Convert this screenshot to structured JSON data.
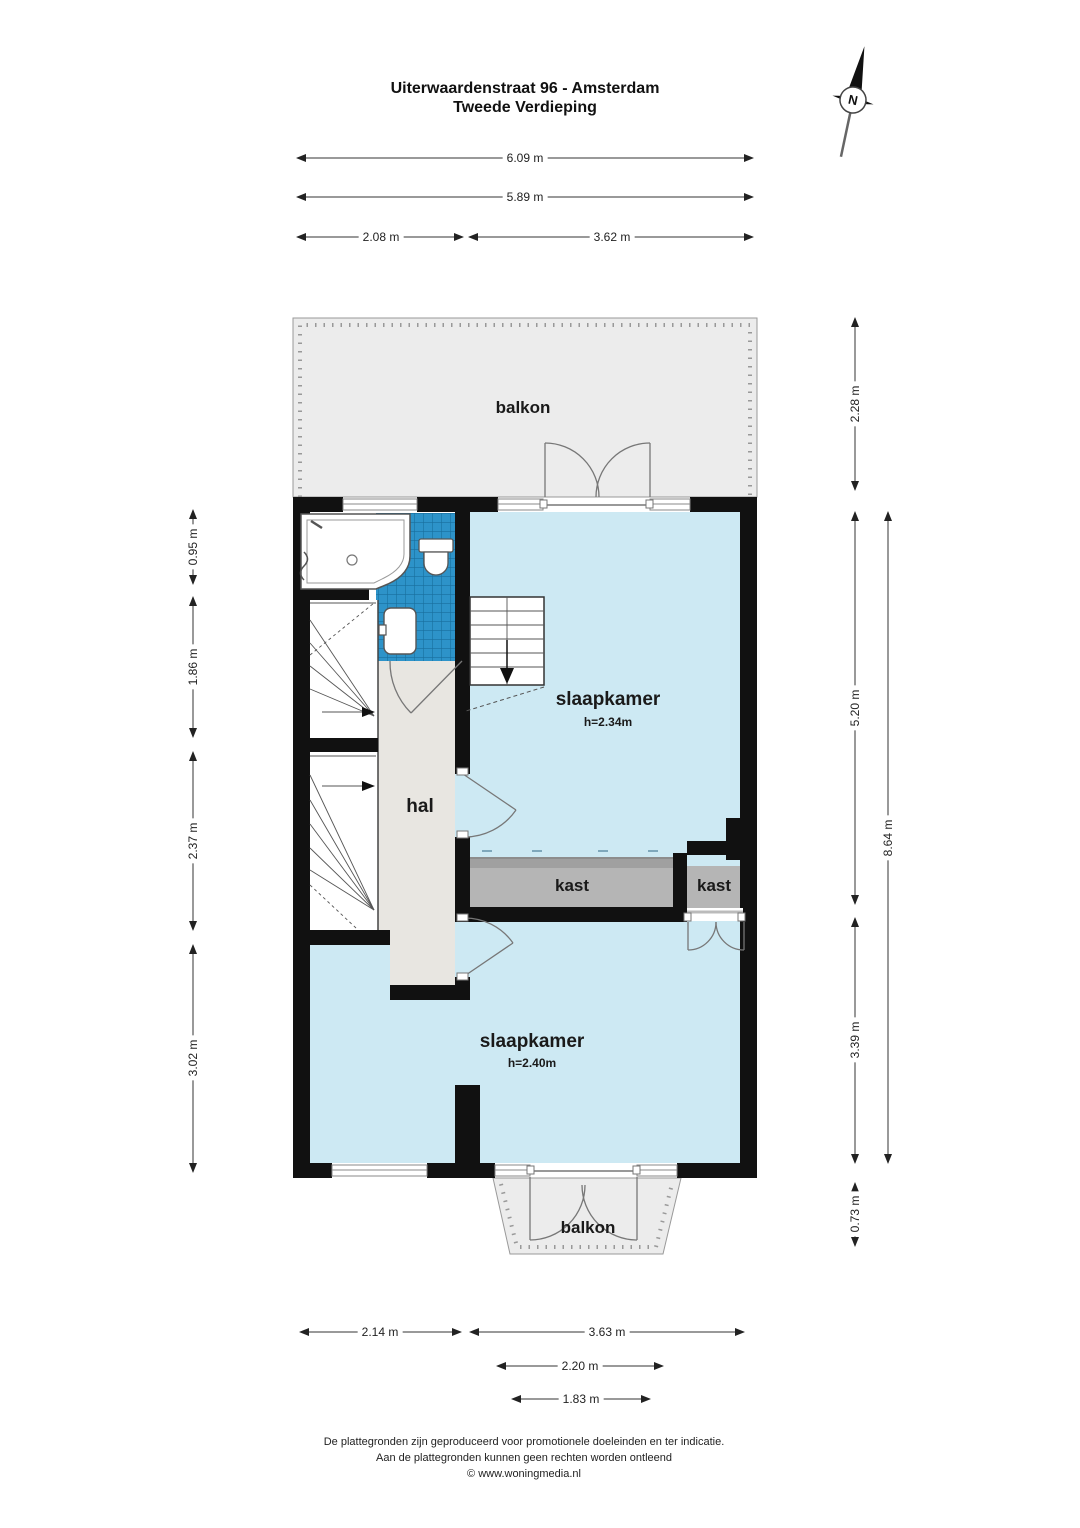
{
  "title": {
    "line1": "Uiterwaardenstraat 96 - Amsterdam",
    "line2": "Tweede Verdieping"
  },
  "compass": {
    "north_label": "N"
  },
  "rooms": {
    "balcony_top": {
      "label": "balkon"
    },
    "bedroom_top": {
      "label": "slaapkamer",
      "ceiling_height": "h=2.34m"
    },
    "hall": {
      "label": "hal"
    },
    "closet_large": {
      "label": "kast"
    },
    "closet_small": {
      "label": "kast"
    },
    "bedroom_bottom": {
      "label": "slaapkamer",
      "ceiling_height": "h=2.40m"
    },
    "balcony_bottom": {
      "label": "balkon"
    }
  },
  "dimensions": {
    "top": [
      {
        "label": "6.09 m"
      },
      {
        "label": "5.89 m"
      },
      {
        "label": "2.08 m"
      },
      {
        "label": "3.62 m"
      }
    ],
    "left": [
      {
        "label": "0.95 m"
      },
      {
        "label": "1.86 m"
      },
      {
        "label": "2.37 m"
      },
      {
        "label": "3.02 m"
      }
    ],
    "right": [
      {
        "label": "2.28 m"
      },
      {
        "label": "5.20 m"
      },
      {
        "label": "3.39 m"
      },
      {
        "label": "0.73 m"
      },
      {
        "label": "8.64 m"
      }
    ],
    "bottom": [
      {
        "label": "2.14 m"
      },
      {
        "label": "3.63 m"
      },
      {
        "label": "2.20 m"
      },
      {
        "label": "1.83 m"
      }
    ]
  },
  "footer": {
    "line1": "De plattegronden zijn geproduceerd voor promotionele doeleinden en ter indicatie.",
    "line2": "Aan de plattegronden kunnen geen rechten worden ontleend",
    "line3": "© www.woningmedia.nl"
  },
  "colors": {
    "wall": "#111111",
    "room_fill": "#cde9f3",
    "hall_fill": "#e8e6e1",
    "balcony_fill": "#ececec",
    "closet_fill": "#b5b5b5",
    "tile_fill": "#2d93c9"
  }
}
